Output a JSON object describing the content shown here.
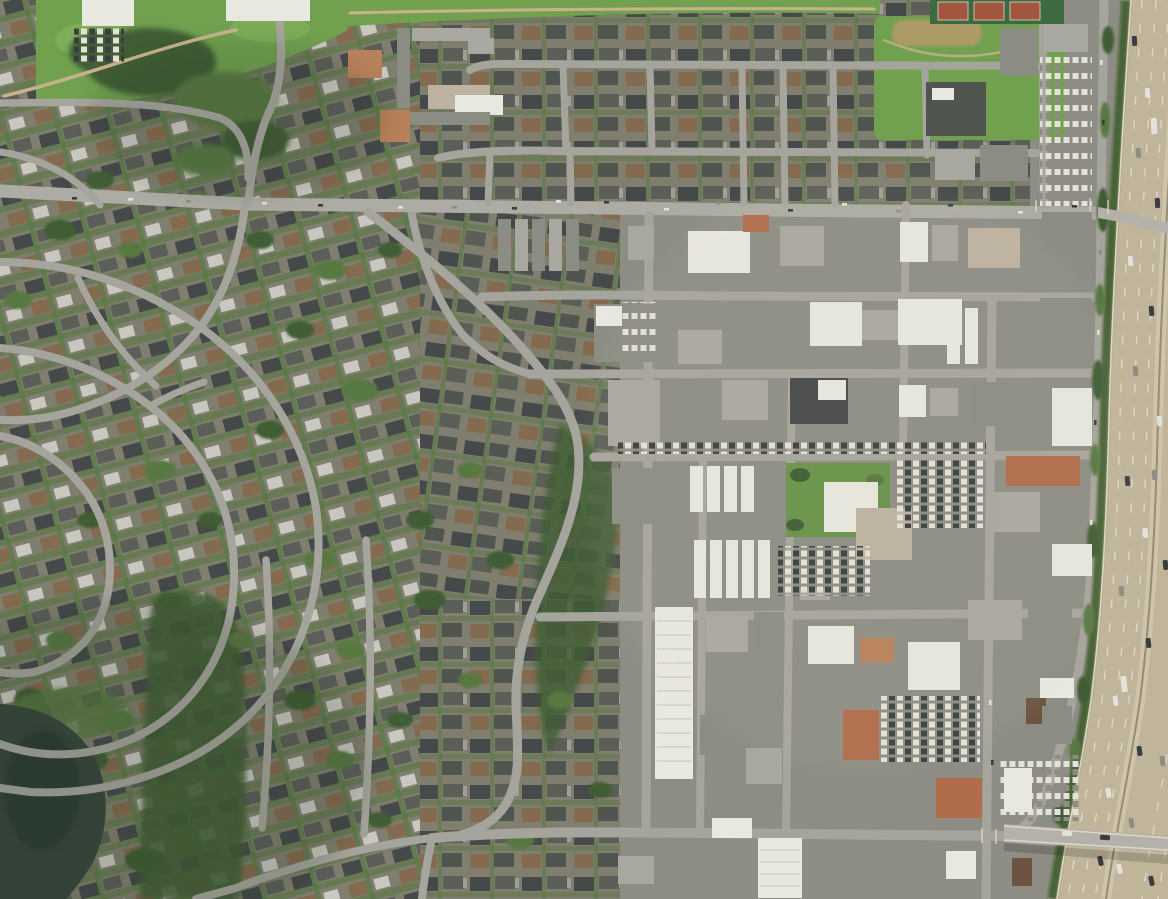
{
  "scene": {
    "type": "satellite-aerial-photo",
    "description": "Aerial satellite view of a suburban city: curvilinear residential streets and greenbelts on the left, a park with school campus and tennis courts at top, a rectangular downtown commercial grid with large white-roofed buildings and parking lots at center-right, and a multi-lane freeway with a frontage road and an overpass along the right edge, with a small pond at bottom-left"
  },
  "features": [
    {
      "id": "park",
      "label": "public park with lawn and tree grove"
    },
    {
      "id": "school-campus",
      "label": "school campus buildings and clay courts"
    },
    {
      "id": "tennis-courts",
      "label": "tennis courts"
    },
    {
      "id": "playfield",
      "label": "green playfield with field house"
    },
    {
      "id": "residential-curvilinear",
      "label": "curving residential streets"
    },
    {
      "id": "residential-grid",
      "label": "gridded residential blocks"
    },
    {
      "id": "commercial-district",
      "label": "downtown commercial grid"
    },
    {
      "id": "civic-buildings",
      "label": "civic center buildings on lawn"
    },
    {
      "id": "parking-lots",
      "label": "parking lots with parked cars"
    },
    {
      "id": "main-arterial-road",
      "label": "east-west arterial road"
    },
    {
      "id": "frontage-road",
      "label": "freeway frontage road"
    },
    {
      "id": "freeway",
      "label": "multi-lane freeway"
    },
    {
      "id": "freeway-overpass",
      "label": "road overpass crossing freeway"
    },
    {
      "id": "pond",
      "label": "pond with marsh edge"
    },
    {
      "id": "greenbelt",
      "label": "tree-lined greenbelt"
    }
  ],
  "palette": {
    "base": "#7e7c6d",
    "resbg": "#807e6e",
    "roofd": "#45494a",
    "roofs": "#5b5f58",
    "roofb": "#846a4e",
    "roofd2": "#515550",
    "roofw": "#c9c8c0",
    "vegd": "#3f5d34",
    "vegm": "#587843",
    "field": "#71a04f",
    "field2": "#82b15c",
    "lawn": "#699349",
    "road": "#a6a59d",
    "arterial": "#adaca4",
    "trail": "#c7b28b",
    "ground": "#8d8d85",
    "bw": "#e9e8e0",
    "bg1": "#a8a7a0",
    "bg2": "#8b8c84",
    "bt": "#bdb3a0",
    "tc": "#b06c4b",
    "tc2": "#b9815a",
    "brn": "#6e5440",
    "fw": "#c0b59b",
    "fwband": "#cfc4a9",
    "fwmed": "#958d7b",
    "dash": "#ded7c3",
    "verge": "#4a6438",
    "pond": "#37473d",
    "pond2": "#2c3a31",
    "carw": "#e3e2da",
    "card": "#3b3e40",
    "carg": "#8f8c84",
    "bridge": "#b3b1a9",
    "dirt": "#b79a6c",
    "court": "#3e6a41",
    "courtred": "#a3563f"
  }
}
